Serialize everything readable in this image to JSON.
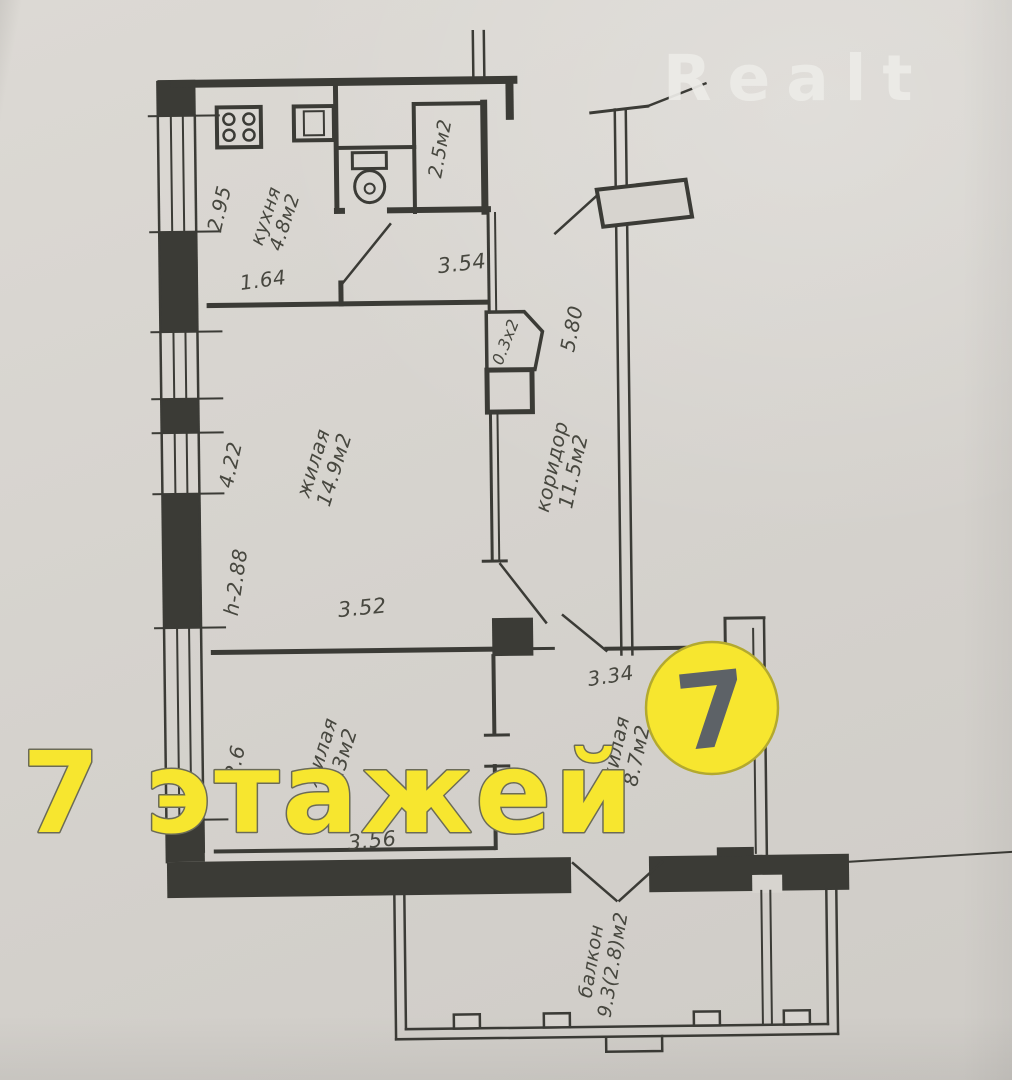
{
  "watermarks": {
    "brand": "Realt",
    "overlay_text": "7 этажей",
    "logo_digit": "7"
  },
  "rooms": {
    "kitchen": {
      "name": "кухня",
      "area": "4.8м2"
    },
    "bathroom": {
      "area": "2.5м2"
    },
    "living1": {
      "name": "жилая",
      "area": "14.9м2"
    },
    "corridor": {
      "name": "коридор",
      "area": "11.5м2"
    },
    "living2": {
      "name": "жилая",
      "area": "9.3м2"
    },
    "living3": {
      "name": "жилая",
      "area": "8.7м2"
    },
    "balcony": {
      "name": "балкон",
      "area": "9.3(2.8)м2"
    }
  },
  "dimensions": {
    "kitchen_width": "2.95",
    "kitchen_door": "1.64",
    "hall_width": "3.54",
    "entry_wall": "5.80",
    "shaft": "0.3х2",
    "living1_depth": "4.22",
    "ceiling_height": "h-2.88",
    "living1_width": "3.52",
    "living2_left": "2.6",
    "living2_width": "3.56",
    "living3_width": "3.34"
  },
  "colors": {
    "paper": "#d7d4cf",
    "ink": "#3b3b36",
    "label_ink": "#47473f",
    "watermark_yellow": "#f7e62f",
    "watermark_outline": "#6b6b57",
    "logo_ring": "#b3a92f",
    "logo_digit_gray": "#5d6267",
    "brand_white": "#edece8"
  }
}
